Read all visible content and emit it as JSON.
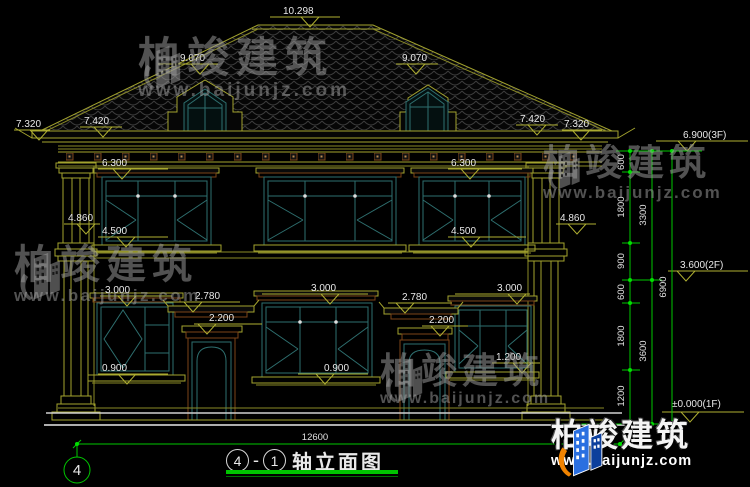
{
  "watermark": {
    "brand": "柏竣建筑",
    "url": "www.baijunjz.com"
  },
  "title": {
    "axis_left": "4",
    "sep": "-",
    "axis_right": "1",
    "name": "轴立面图"
  },
  "grid": {
    "left_bubble": "4"
  },
  "levels": [
    "10.298",
    "9.070",
    "9.070",
    "7.320",
    "7.420",
    "7.420",
    "7.320",
    "6.300",
    "6.300",
    "4.860",
    "4.860",
    "4.500",
    "4.500",
    "3.000",
    "3.000",
    "3.000",
    "2.780",
    "2.780",
    "2.200",
    "2.200",
    "0.900",
    "0.900",
    "1.200"
  ],
  "floor_levels": [
    "6.900(3F)",
    "3.600(2F)",
    "±0.000(1F)"
  ],
  "dims": {
    "segments": [
      "600",
      "1800",
      "900",
      "600",
      "1800",
      "1200"
    ],
    "subtotals": [
      "3300",
      "3600"
    ],
    "total": "6900",
    "width": "12600"
  }
}
